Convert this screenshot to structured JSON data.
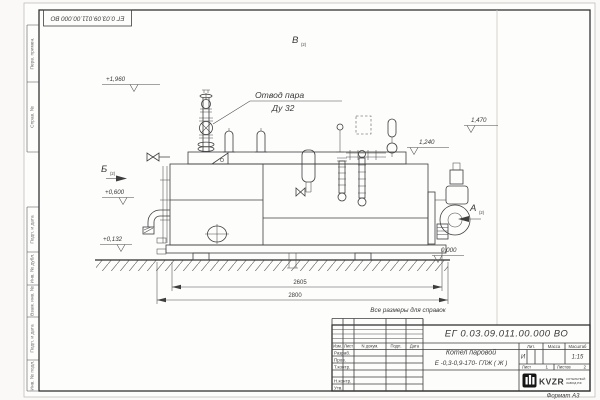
{
  "corner_stamp": {
    "doc_number": "ЕГ 0.03.09.011.00.000  ВО"
  },
  "margin_stamps": {
    "perv_primen": "Перв. примен.",
    "sprav_no": "Справ. №",
    "podp_data_1": "Подп. и дата",
    "inv_dubl": "Инв. № дубл.",
    "vzam_inv": "Взам. инв. №",
    "podp_data_2": "Подп. и дата",
    "inv_podl": "Инв. № подл."
  },
  "drawing": {
    "callout": {
      "line1": "Отвод пара",
      "line2": "Ду 32"
    },
    "elevations": {
      "e1960": "+1,960",
      "e1470": "1,470",
      "e1240": "1,240",
      "e0600": "+0,600",
      "e0132": "+0,132",
      "e0000": "0,000"
    },
    "views": {
      "b": "Б",
      "b_sub": "(2)",
      "v": "В",
      "v_sub": "(2)",
      "a": "А",
      "a_sub": "(2)"
    },
    "dimensions": {
      "d2605": "2605",
      "d2800": "2800"
    },
    "note": "Все размеры для справок"
  },
  "title_block": {
    "doc_number": "ЕГ 0.03.09.011.00.000  ВО",
    "product_line1": "Котел паровой",
    "product_line2": "Е -0,3-0,9-170- ГЛЖ ( Ж )",
    "cols": {
      "izm": "Изм.",
      "list": "Лист",
      "ndoc": "N докум.",
      "podp": "Подп.",
      "data": "Дата"
    },
    "rows": {
      "razrab": "Разраб.",
      "prov": "Пров.",
      "tkontr": "Т.контр.",
      "nkontr": "Н.контр.",
      "utv": "Утв."
    },
    "lit": {
      "header": "Лит.",
      "value": "И"
    },
    "mass": {
      "header": "Масса"
    },
    "scale": {
      "header": "Масштаб",
      "value": "1:15"
    },
    "sheet": {
      "label": "Лист",
      "value": "1"
    },
    "sheets": {
      "label": "Листов",
      "value": "2"
    },
    "logo": {
      "text": "KVZR",
      "sub1": "КОТЕЛЬНЫЙ",
      "sub2": "ЗАВОД РФ"
    },
    "format": "Формат А3"
  }
}
